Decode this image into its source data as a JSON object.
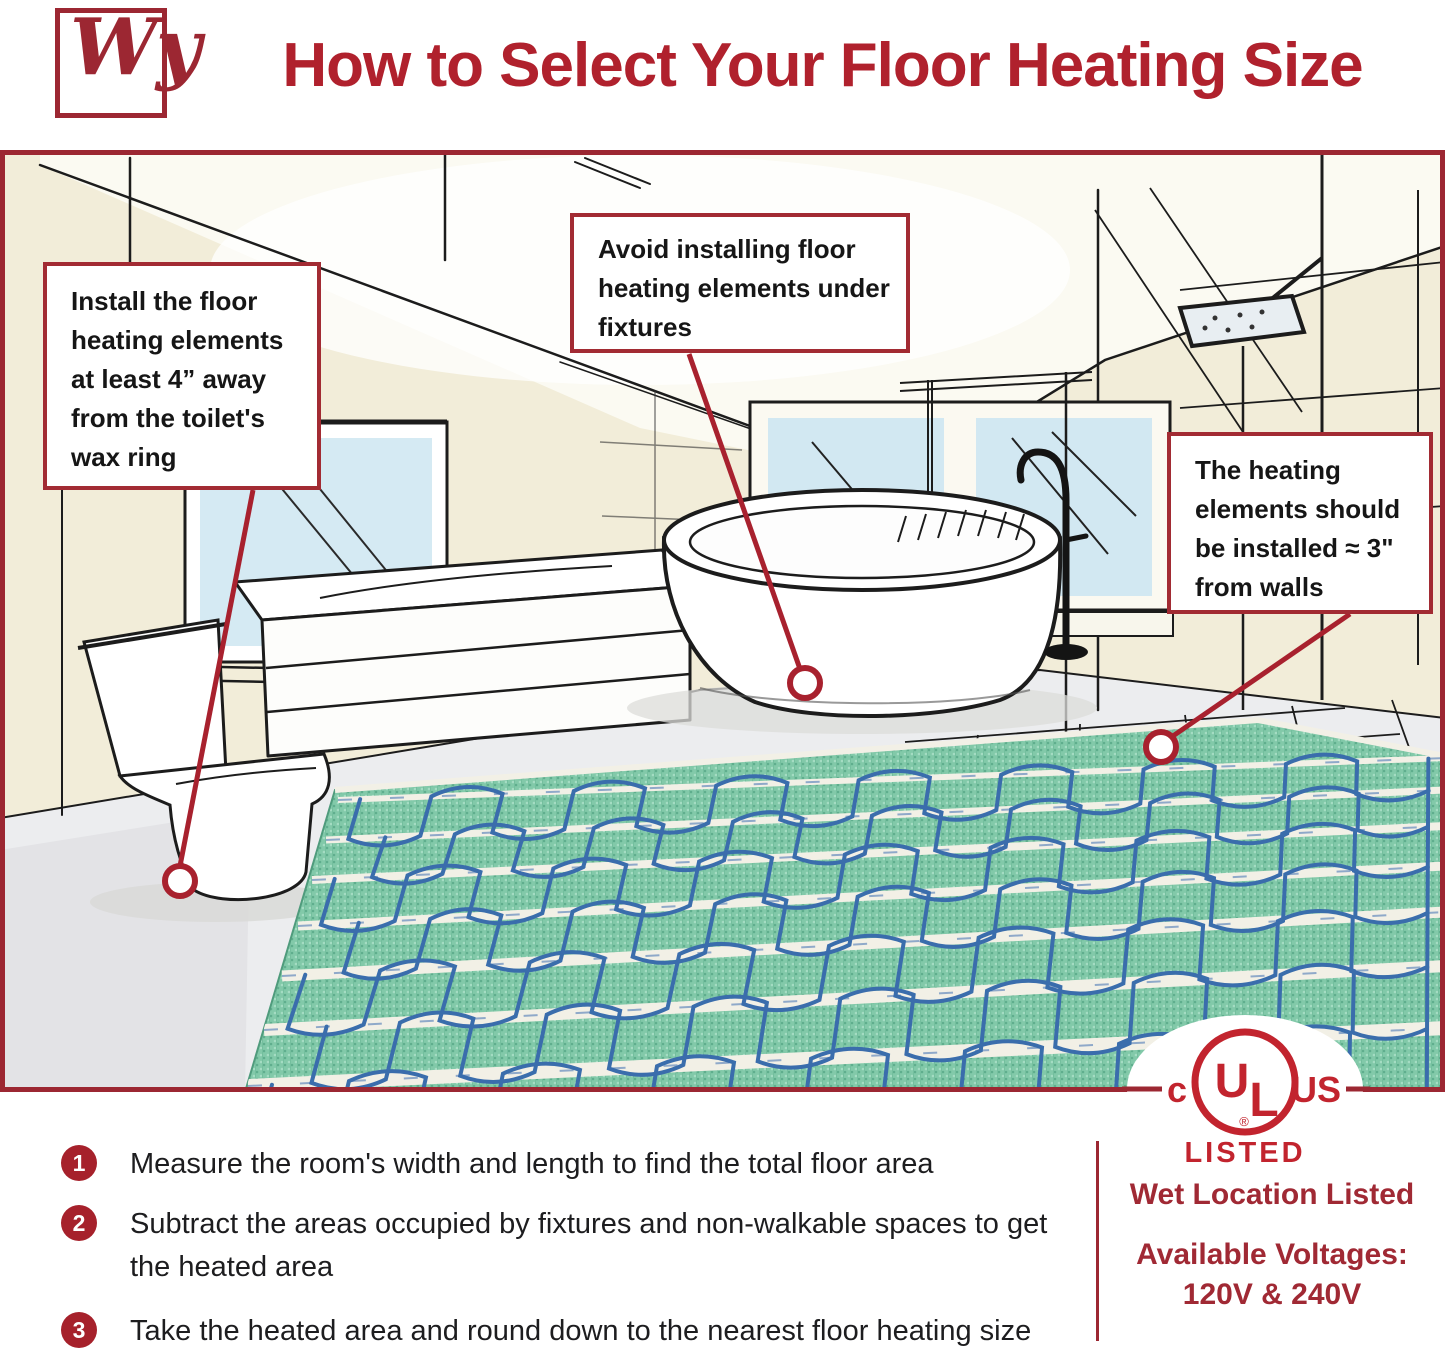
{
  "header": {
    "logo_text": "Wy",
    "title": "How to Select Your Floor Heating Size"
  },
  "illustration": {
    "callouts": [
      {
        "id": "toilet",
        "text": "Install the floor heating elements at least 4” away from the toilet's wax ring"
      },
      {
        "id": "fixtures",
        "text": "Avoid installing floor heating elements under fixtures"
      },
      {
        "id": "walls",
        "text": "The heating elements should be installed ≈ 3\" from walls"
      }
    ]
  },
  "steps": [
    {
      "number": "1",
      "text": "Measure the room's width and length to find the total floor area"
    },
    {
      "number": "2",
      "text": "Subtract the areas occupied by fixtures and non-walkable spaces to get the heated area"
    },
    {
      "number": "3",
      "text": "Take the heated area and round down to the nearest floor heating size"
    }
  ],
  "certification": {
    "ul_c": "c",
    "ul_u": "U",
    "ul_l": "L",
    "ul_reg": "®",
    "ul_us": "US",
    "listed": "LISTED",
    "wet_location": "Wet Location Listed",
    "voltages_label": "Available Voltages:",
    "voltages_value": "120V & 240V"
  },
  "colors": {
    "accent": "#9C2732",
    "title_red": "#B0212D",
    "ul_red": "#C2242E",
    "badge_red": "#A6212B",
    "mat_green": "#82C9A9",
    "cable_blue": "#3A6DAC"
  }
}
